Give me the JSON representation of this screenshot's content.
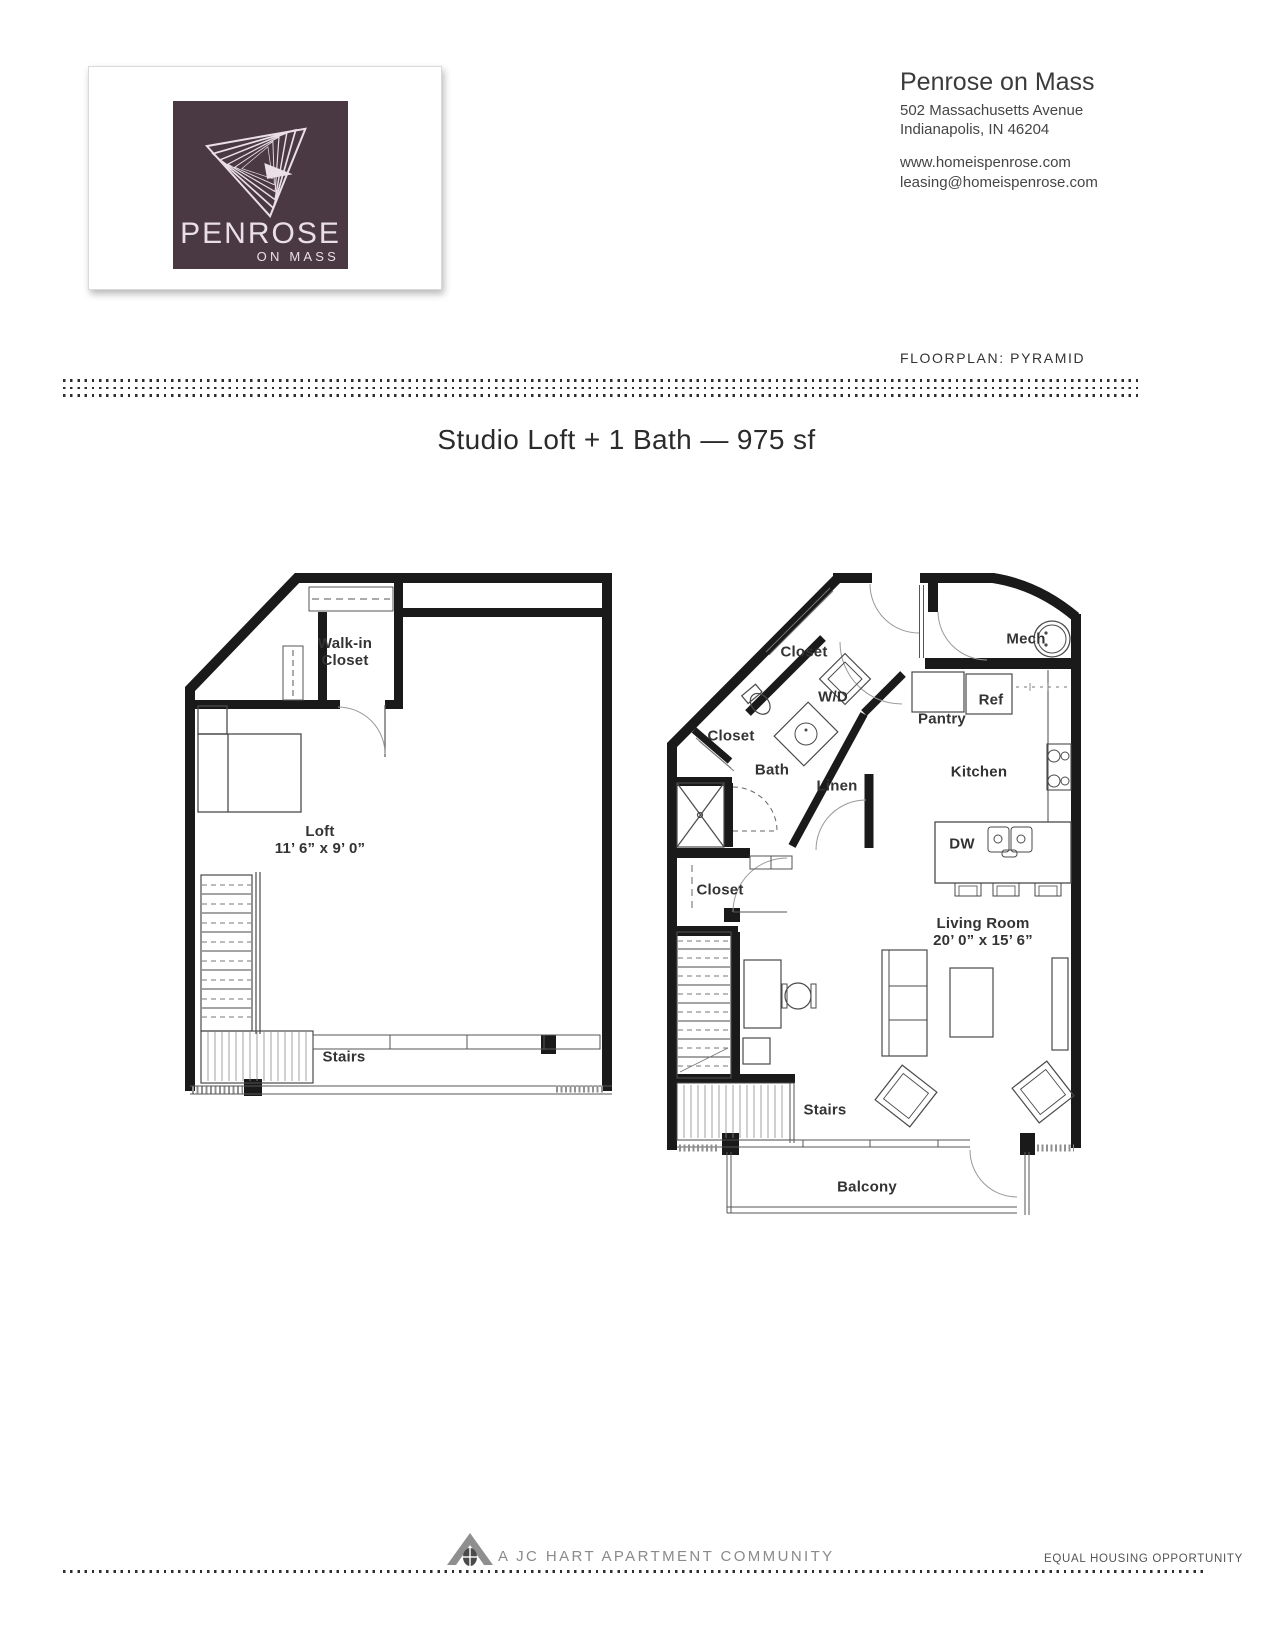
{
  "header": {
    "logo": {
      "brand": "PENROSE",
      "tagline": "ON MASS"
    },
    "property_name": "Penrose on Mass",
    "address_line1": "502 Massachusetts Avenue",
    "address_line2": "Indianapolis, IN 46204",
    "website": "www.homeispenrose.com",
    "email": "leasing@homeispenrose.com",
    "floorplan_label": "FLOORPLAN: PYRAMID"
  },
  "title": "Studio Loft + 1 Bath — 975 sf",
  "loft_plan": {
    "walk_in_line1": "Walk-in",
    "walk_in_line2": "Closet",
    "room_name": "Loft",
    "room_dims": "11’ 6” x 9’ 0”",
    "stairs": "Stairs"
  },
  "main_plan": {
    "closet_top": "Closet",
    "washer_dryer": "W/D",
    "mech": "Mech",
    "ref": "Ref",
    "pantry": "Pantry",
    "closet_mid": "Closet",
    "bath": "Bath",
    "linen": "Linen",
    "kitchen": "Kitchen",
    "dishwasher": "DW",
    "closet_low": "Closet",
    "living_room": "Living Room",
    "living_room_dims": "20’ 0” x 15’ 6”",
    "stairs": "Stairs",
    "balcony": "Balcony"
  },
  "footer": {
    "community": "A JC HART APARTMENT COMMUNITY",
    "equal_housing": "EQUAL HOUSING OPPORTUNITY"
  },
  "colors": {
    "logo_bg": "#4a3842",
    "logo_text": "#eadfe7",
    "wall": "#1a1a1a",
    "label": "#333333"
  }
}
